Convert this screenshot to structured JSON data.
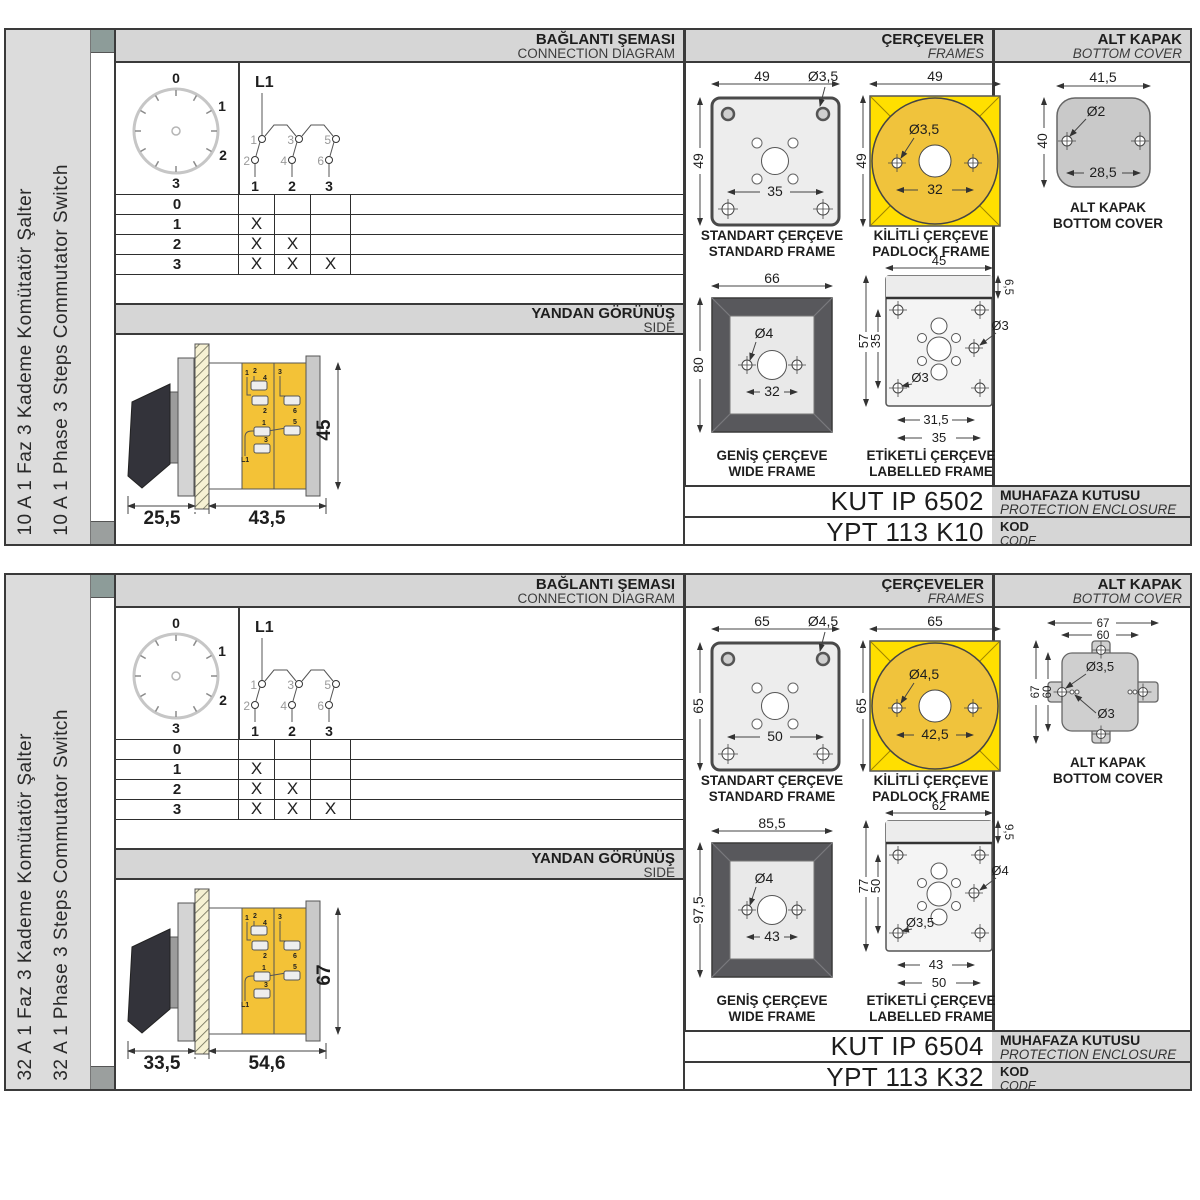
{
  "panels": [
    {
      "sidebar": {
        "title_tr": "10 A 1 Faz 3 Kademe Komütatör Şalter",
        "title_en": "10 A 1 Phase 3 Steps Commutator Switch"
      },
      "headers": {
        "connection_tr": "BAĞLANTI ŞEMASI",
        "connection_en": "CONNECTION DIAGRAM",
        "frames_tr": "ÇERÇEVELER",
        "frames_en": "FRAMES",
        "cover_tr": "ALT KAPAK",
        "cover_en": "BOTTOM COVER",
        "side_tr": "YANDAN GÖRÜNÜŞ",
        "side_en": "SIDE"
      },
      "dial": {
        "p0": "0",
        "p1": "1",
        "p2": "2",
        "p3": "3"
      },
      "circuit": {
        "line": "L1",
        "t1": "1",
        "t2": "2",
        "t3": "3",
        "t4": "4",
        "t5": "5",
        "t6": "6",
        "pole1": "1",
        "pole2": "2",
        "pole3": "3"
      },
      "step_table": {
        "rows": [
          {
            "label": "0",
            "c1": "",
            "c2": "",
            "c3": ""
          },
          {
            "label": "1",
            "c1": "X",
            "c2": "",
            "c3": ""
          },
          {
            "label": "2",
            "c1": "X",
            "c2": "X",
            "c3": ""
          },
          {
            "label": "3",
            "c1": "X",
            "c2": "X",
            "c3": "X"
          }
        ]
      },
      "side_view": {
        "depth_handle": "25,5",
        "depth_body": "43,5",
        "height": "45",
        "t_labels": {
          "a": "1",
          "b": "2",
          "c": "4",
          "d": "2",
          "e": "3",
          "f": "6",
          "g": "1",
          "h": "5",
          "i": "3",
          "j": "L1"
        }
      },
      "frames": {
        "standard": {
          "cap_tr": "STANDART ÇERÇEVE",
          "cap_en": "STANDARD FRAME",
          "width": "49",
          "height": "49",
          "hole": "Ø3,5",
          "inner": "35"
        },
        "padlock": {
          "cap_tr": "KİLİTLİ ÇERÇEVE",
          "cap_en": "PADLOCK FRAME",
          "width": "49",
          "height": "49",
          "hole": "Ø3,5",
          "inner": "32"
        },
        "wide": {
          "cap_tr": "GENİŞ ÇERÇEVE",
          "cap_en": "WIDE FRAME",
          "width": "66",
          "height": "80",
          "hole": "Ø4",
          "inner": "32"
        },
        "labelled": {
          "cap_tr": "ETİKETLİ ÇERÇEVE",
          "cap_en": "LABELLED FRAME",
          "width": "45",
          "strip": "6,5",
          "height": "57",
          "inner_height": "35",
          "hole_side": "Ø3",
          "hole_corner": "Ø3",
          "dim_a": "31,5",
          "dim_b": "35"
        }
      },
      "cover": {
        "cap_tr": "ALT KAPAK",
        "cap_en": "BOTTOM COVER",
        "width": "41,5",
        "height": "40",
        "hole": "Ø2",
        "spacing": "28,5"
      },
      "codes": {
        "enclosure": "KUT IP 6502",
        "enclosure_tr": "MUHAFAZA KUTUSU",
        "enclosure_en": "PROTECTION ENCLOSURE",
        "code": "YPT 113 K10",
        "code_tr": "KOD",
        "code_en": "CODE"
      }
    },
    {
      "sidebar": {
        "title_tr": "32 A 1 Faz 3 Kademe Komütatör Şalter",
        "title_en": "32 A 1 Phase 3 Steps Commutator Switch"
      },
      "headers": {
        "connection_tr": "BAĞLANTI ŞEMASI",
        "connection_en": "CONNECTION DIAGRAM",
        "frames_tr": "ÇERÇEVELER",
        "frames_en": "FRAMES",
        "cover_tr": "ALT KAPAK",
        "cover_en": "BOTTOM COVER",
        "side_tr": "YANDAN GÖRÜNÜŞ",
        "side_en": "SIDE"
      },
      "dial": {
        "p0": "0",
        "p1": "1",
        "p2": "2",
        "p3": "3"
      },
      "circuit": {
        "line": "L1",
        "t1": "1",
        "t2": "2",
        "t3": "3",
        "t4": "4",
        "t5": "5",
        "t6": "6",
        "pole1": "1",
        "pole2": "2",
        "pole3": "3"
      },
      "step_table": {
        "rows": [
          {
            "label": "0",
            "c1": "",
            "c2": "",
            "c3": ""
          },
          {
            "label": "1",
            "c1": "X",
            "c2": "",
            "c3": ""
          },
          {
            "label": "2",
            "c1": "X",
            "c2": "X",
            "c3": ""
          },
          {
            "label": "3",
            "c1": "X",
            "c2": "X",
            "c3": "X"
          }
        ]
      },
      "side_view": {
        "depth_handle": "33,5",
        "depth_body": "54,6",
        "height": "67",
        "t_labels": {
          "a": "1",
          "b": "2",
          "c": "4",
          "d": "2",
          "e": "3",
          "f": "6",
          "g": "1",
          "h": "5",
          "i": "3",
          "j": "L1"
        }
      },
      "frames": {
        "standard": {
          "cap_tr": "STANDART ÇERÇEVE",
          "cap_en": "STANDARD FRAME",
          "width": "65",
          "height": "65",
          "hole": "Ø4,5",
          "inner": "50"
        },
        "padlock": {
          "cap_tr": "KİLİTLİ ÇERÇEVE",
          "cap_en": "PADLOCK FRAME",
          "width": "65",
          "height": "65",
          "hole": "Ø4,5",
          "inner": "42,5"
        },
        "wide": {
          "cap_tr": "GENİŞ ÇERÇEVE",
          "cap_en": "WIDE FRAME",
          "width": "85,5",
          "height": "97,5",
          "hole": "Ø4",
          "inner": "43"
        },
        "labelled": {
          "cap_tr": "ETİKETLİ ÇERÇEVE",
          "cap_en": "LABELLED FRAME",
          "width": "62",
          "strip": "9,5",
          "height": "77",
          "inner_height": "50",
          "hole_side": "Ø4",
          "hole_corner": "Ø3,5",
          "dim_a": "43",
          "dim_b": "50"
        }
      },
      "cover": {
        "cap_tr": "ALT KAPAK",
        "cap_en": "BOTTOM COVER",
        "width_outer": "67",
        "width_inner": "60",
        "height_outer": "67",
        "height_inner": "60",
        "hole_tab": "Ø3,5",
        "hole_small": "Ø3"
      },
      "codes": {
        "enclosure": "KUT IP 6504",
        "enclosure_tr": "MUHAFAZA KUTUSU",
        "enclosure_en": "PROTECTION ENCLOSURE",
        "code": "YPT 113 K32",
        "code_tr": "KOD",
        "code_en": "CODE"
      }
    }
  ]
}
